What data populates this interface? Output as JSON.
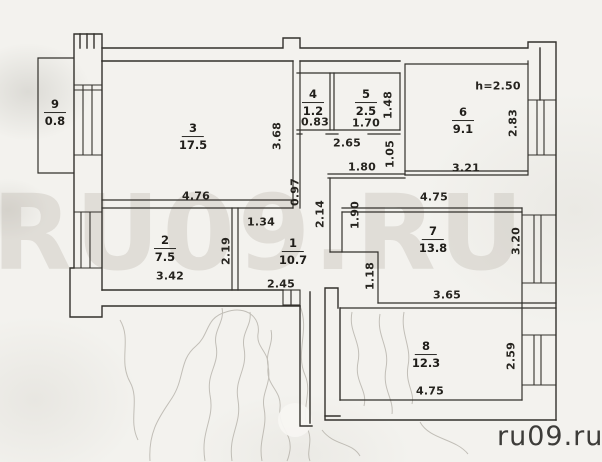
{
  "document": {
    "type_note": "scanned apartment floor plan",
    "watermark_large": "RU09.RU",
    "watermark_corner": "ru09.ru",
    "ceiling_height": "h=2.50"
  },
  "rooms": [
    {
      "number": "1",
      "area": "10.7"
    },
    {
      "number": "2",
      "area": "7.5"
    },
    {
      "number": "3",
      "area": "17.5"
    },
    {
      "number": "4",
      "area": "1.2"
    },
    {
      "number": "5",
      "area": "2.5"
    },
    {
      "number": "6",
      "area": "9.1"
    },
    {
      "number": "7",
      "area": "13.8"
    },
    {
      "number": "8",
      "area": "12.3"
    },
    {
      "number": "9",
      "area": "0.8"
    }
  ],
  "dims": {
    "room3_width": "4.76",
    "room3_height": "3.68",
    "room3_door": "0.97",
    "hall_top": "1.34",
    "room2_width": "3.42",
    "room2_height": "2.19",
    "hall_bottom": "2.45",
    "room4_width": "0.83",
    "room5_width": "1.70",
    "room5_height": "1.48",
    "corridor_width": "2.65",
    "corridor_inner": "1.80",
    "corridor_height": "1.05",
    "room6_width": "3.21",
    "room6_height": "2.83",
    "room7_top": "4.75",
    "room7_bottom": "3.65",
    "room7_height": "3.20",
    "room7_left": "1.90",
    "hall_passage": "2.14",
    "room7_notch": "1.18",
    "room8_width": "4.75",
    "room8_height": "2.59"
  },
  "colors": {
    "paper": "#f3f2ee",
    "ink": "#33312c",
    "watermark": "rgba(176,170,158,0.28)",
    "corner_text": "#3d3c39"
  }
}
